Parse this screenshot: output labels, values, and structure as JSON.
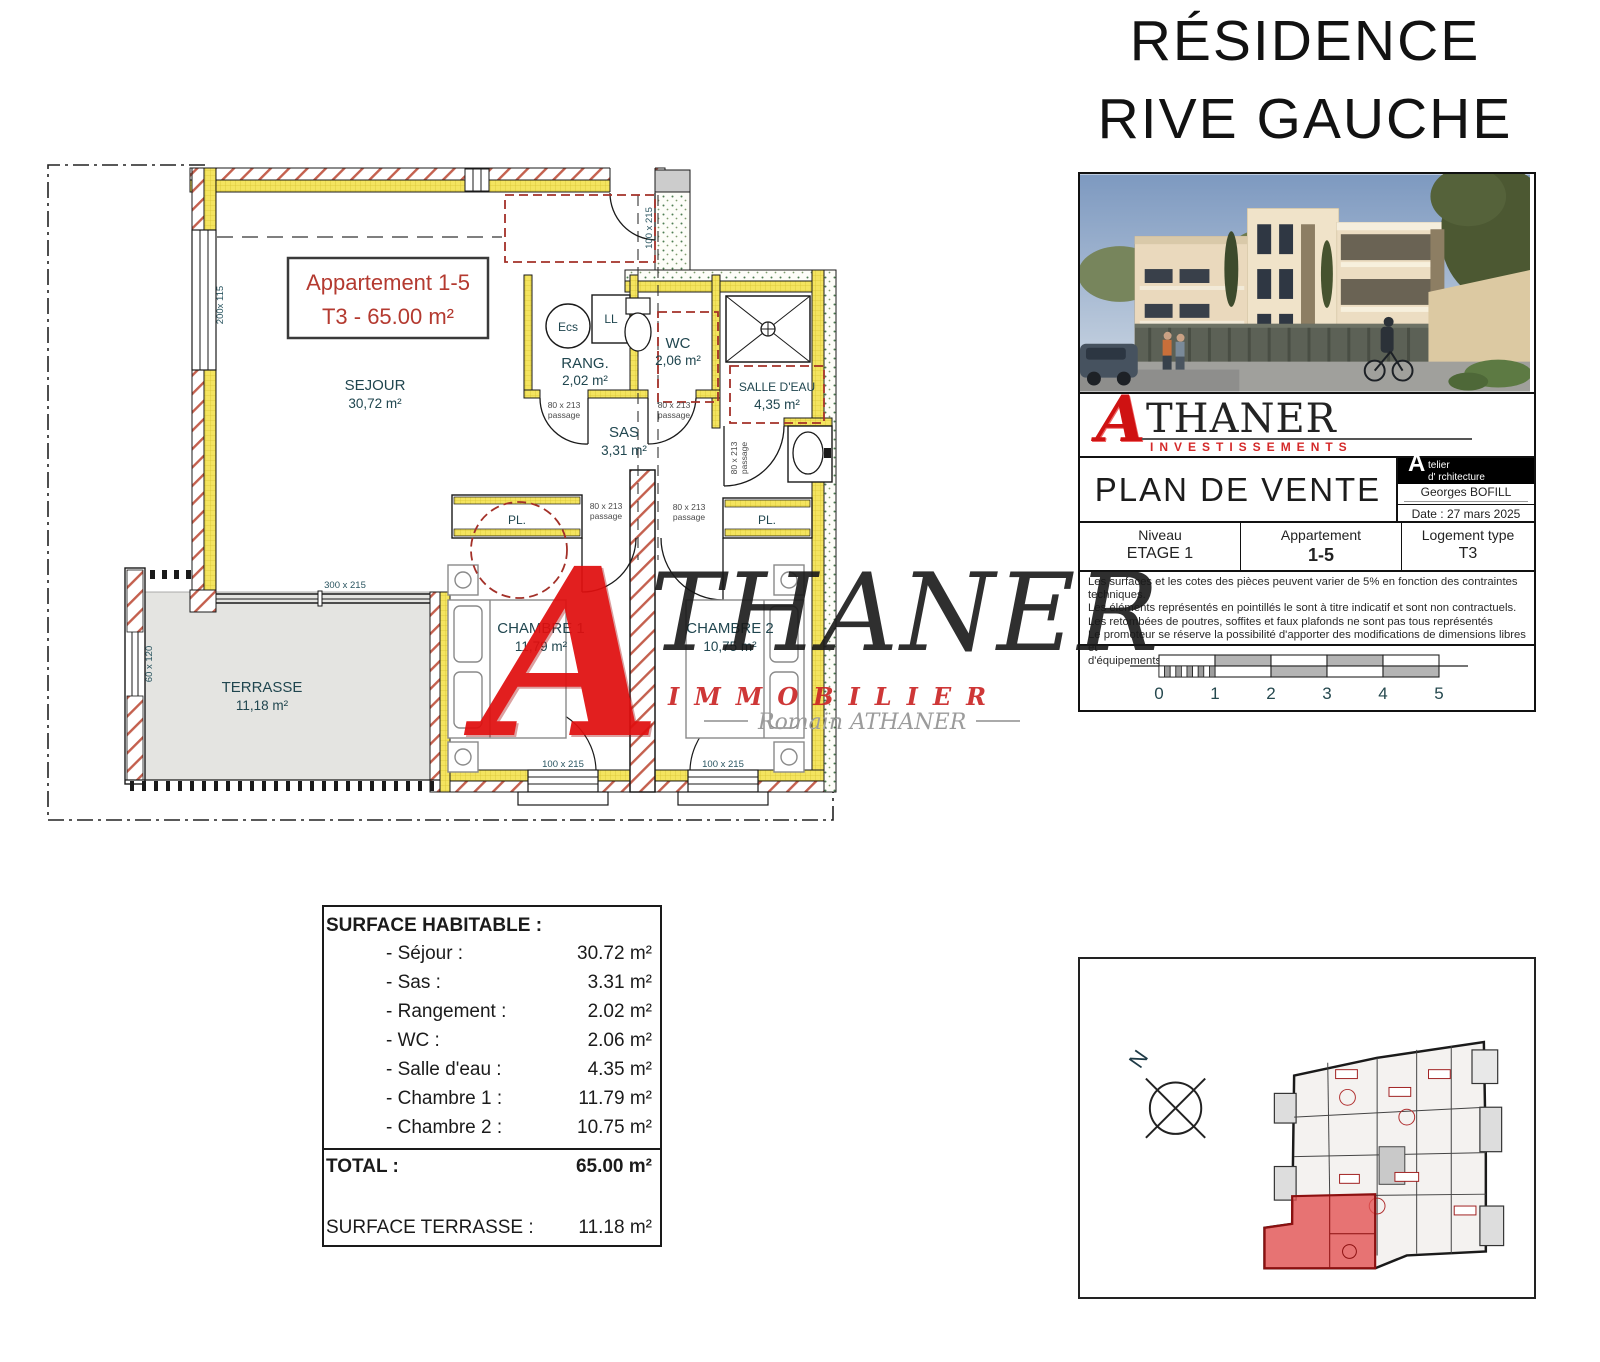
{
  "brand": {
    "residence_line1": "RÉSIDENCE",
    "residence_line2": "RIVE GAUCHE",
    "logo_a": "A",
    "logo_name": "THANER",
    "invest_sub": "INVESTISSEMENTS",
    "immo_sub": "IMMOBILIER",
    "signature": "Romain ATHANER"
  },
  "title_block": {
    "doc_title": "PLAN DE VENTE",
    "stamp": {
      "big_a": "A",
      "line1": "telier",
      "line2": "d'  rchitecture",
      "name": "Georges BOFILL",
      "date": "Date : 27 mars 2025"
    },
    "fields": [
      {
        "label": "Niveau",
        "value": "ETAGE 1"
      },
      {
        "label": "Appartement",
        "value": "1-5"
      },
      {
        "label": "Logement type",
        "value": "T3"
      }
    ],
    "disclaimer": [
      "Les surfaces et les cotes des pièces peuvent varier de 5% en fonction des contraintes techniques.",
      "Les éléments représentés en pointillés le sont à titre indicatif et sont non contractuels.",
      "Les retombées de poutres, soffites et faux plafonds ne sont pas tous représentés",
      "Le promoteur se réserve la possibilité d'apporter des modifications de dimensions libres et",
      "d'équipements en fonction des contraintes techniques d'exécution."
    ],
    "scale": [
      "0",
      "1",
      "2",
      "3",
      "4",
      "5"
    ]
  },
  "floorplan": {
    "apartment_box": {
      "line1": "Appartement 1-5",
      "line2": "T3 - 65.00 m²"
    },
    "rooms": {
      "sejour": {
        "name": "SEJOUR",
        "area": "30,72 m²"
      },
      "rang": {
        "name": "RANG.",
        "area": "2,02 m²"
      },
      "wc": {
        "name": "WC",
        "area": "2,06 m²"
      },
      "salle_eau": {
        "name": "SALLE D'EAU",
        "area": "4,35 m²"
      },
      "sas": {
        "name": "SAS",
        "area": "3,31 m²"
      },
      "chambre1": {
        "name": "CHAMBRE 1",
        "area": "11,79 m²"
      },
      "chambre2": {
        "name": "CHAMBRE 2",
        "area": "10,75 m²"
      },
      "terrasse": {
        "name": "TERRASSE",
        "area": "11,18 m²"
      },
      "placard": "PL.",
      "ecs": "Ecs",
      "ll": "LL"
    },
    "dims": {
      "window_left": "200x 115",
      "door_entrance": "100 x 215",
      "bay_window": "300 x 215",
      "terrace_side": "60 x 120",
      "passage_size": "80 x 213",
      "passage_word": "passage",
      "window_bedroom": "100 x 215"
    }
  },
  "surface_table": {
    "title": "SURFACE HABITABLE :",
    "rows": [
      {
        "label": "- Séjour :",
        "value": "30.72 m²"
      },
      {
        "label": "- Sas :",
        "value": "3.31 m²"
      },
      {
        "label": "- Rangement :",
        "value": "2.02 m²"
      },
      {
        "label": "- WC :",
        "value": "2.06 m²"
      },
      {
        "label": "- Salle d'eau :",
        "value": "4.35 m²"
      },
      {
        "label": "- Chambre 1 :",
        "value": "11.79 m²"
      },
      {
        "label": "- Chambre 2 :",
        "value": "10.75 m²"
      }
    ],
    "total_label": "TOTAL :",
    "total_value": "65.00 m²",
    "terrasse_label": "SURFACE TERRASSE :",
    "terrasse_value": "11.18 m²"
  },
  "site_plan": {
    "north": "N"
  },
  "colors": {
    "accent_red": "#b43a30",
    "wall_yellow": "#f4e45f",
    "terrace_gray": "#e4e4e1",
    "label_teal": "#20464f"
  }
}
